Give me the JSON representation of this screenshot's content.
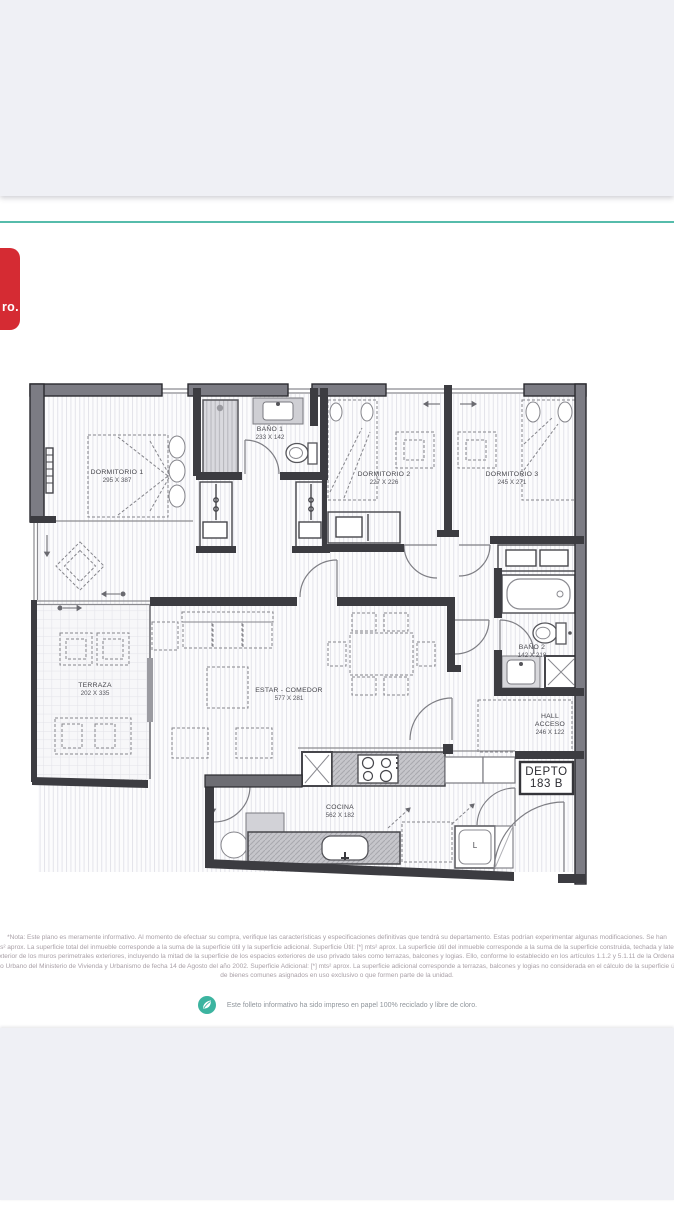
{
  "page": {
    "accent_teal": "#56bcab",
    "logo_red": "#d52b33",
    "logo_text": "ro."
  },
  "plan": {
    "unit_label": {
      "line1": "DEPTO",
      "line2": "183 B"
    },
    "appliance_label": "L",
    "rooms": [
      {
        "name": "DORMITORIO 1",
        "dims": "295 X 387"
      },
      {
        "name": "BAÑO 1",
        "dims": "233 X 142"
      },
      {
        "name": "DORMITORIO 2",
        "dims": "227 X 226"
      },
      {
        "name": "DORMITORIO 3",
        "dims": "245 X 271"
      },
      {
        "name": "TERRAZA",
        "dims": "202 X 335"
      },
      {
        "name": "ESTAR - COMEDOR",
        "dims": "577 X 281"
      },
      {
        "name": "BAÑO 2",
        "dims": "142 X 218"
      },
      {
        "name": "HALL ACCESO",
        "dims": "246 X 122"
      },
      {
        "name": "COCINA",
        "dims": "562 X 182"
      }
    ]
  },
  "footer": {
    "disclaimer_lines": [
      "*Nota: Este plano es meramente informativo. Al momento de efectuar su compra, verifique las características y especificaciones definitivas que tendrá su departamento. Estas podrían experimentar algunas modificaciones. Se han",
      "mts² aprox. La superficie total del inmueble corresponde a la suma de la superficie útil y la superficie adicional. Superficie Útil: [*] mts² aprox. La superficie útil del inmueble corresponde a la suma de la superficie construida, techada y lateral",
      "al exterior de los muros perimetrales exteriores, incluyendo la mitad de la superficie de los espacios exteriores de uso privado tales como terrazas, balcones y logias. Ello, conforme lo establecido en los artículos 1.1.2 y 5.1.11 de la Ordenanza",
      "oto Urbano del Ministerio de Vivienda y Urbanismo de fecha 14 de Agosto del año 2002. Superficie Adicional: [*] mts² aprox. La superficie adicional corresponde a terrazas, balcones y logias no considerada en el cálculo de la superficie útil",
      "de bienes comunes asignados en uso exclusivo o que formen parte de la unidad."
    ],
    "eco_note": "Este folleto informativo ha sido impreso en papel 100% reciclado y libre de cloro."
  }
}
